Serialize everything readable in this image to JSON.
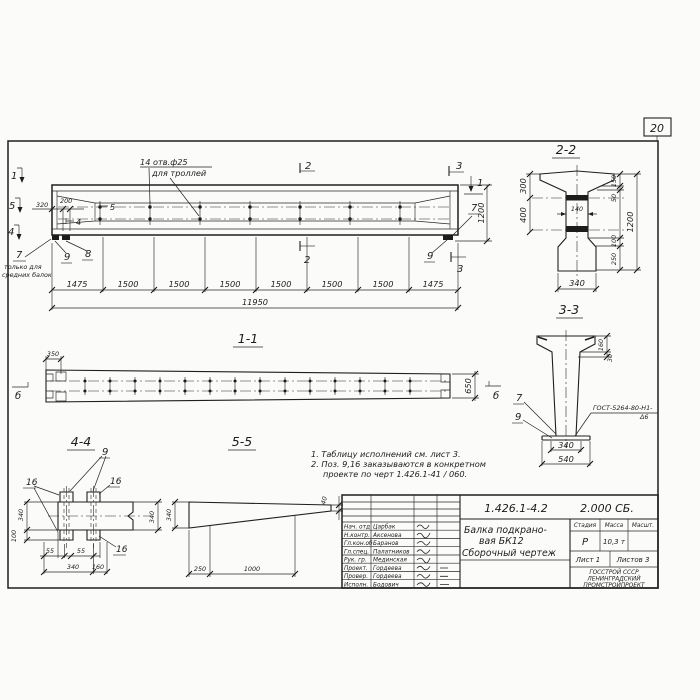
{
  "sheet": {
    "number": "20"
  },
  "main_view": {
    "holes_label_1": "14 отв.ф25",
    "holes_label_2": "для троллей",
    "mark_1_left": "1",
    "mark_5_left": "5",
    "mark_4_left": "4",
    "mark_5_inner": "5",
    "mark_4_inner": "4",
    "mark_2_top": "2",
    "mark_2_bottom": "2",
    "mark_3_top": "3",
    "mark_3_bottom": "3",
    "mark_1_right": "1",
    "callout_7_left": "7",
    "callout_7_note_1": "только для",
    "callout_7_note_2": "средних балок",
    "callout_9_left": "9",
    "callout_8_left": "8",
    "callout_7_right": "7",
    "callout_9_right": "9",
    "dim_320": "320",
    "dim_200": "200",
    "dim_1200": "1200",
    "dim_segments": [
      "1475",
      "1500",
      "1500",
      "1500",
      "1500",
      "1500",
      "1500",
      "1475"
    ],
    "dim_total": "11950"
  },
  "section_1_1": {
    "title": "1-1",
    "dim_350": "350",
    "dim_650": "650",
    "cut_mark_left": "б",
    "cut_mark_right": "б"
  },
  "section_2_2": {
    "title": "2-2",
    "dim_300": "300",
    "dim_400": "400",
    "dim_150": "150",
    "dim_50": "50",
    "dim_1200": "1200",
    "dim_100": "100",
    "dim_250": "250",
    "dim_140": "140",
    "dim_340": "340"
  },
  "section_3_3": {
    "title": "3-3",
    "dim_160": "160",
    "dim_30": "30",
    "dim_340": "340",
    "dim_540": "540",
    "callout_7": "7",
    "callout_9": "9",
    "weld_label_1": "ГОСТ-5264-80-Н1-",
    "weld_label_2": "Δ6"
  },
  "section_4_4": {
    "title": "4-4",
    "callout_9": "9",
    "callout_16_a": "16",
    "callout_16_b": "16",
    "callout_16_c": "16",
    "dim_340_left": "340",
    "dim_100": "100",
    "dim_340_right": "340",
    "dim_55_a": "55",
    "dim_55_b": "55",
    "dim_340_bottom": "340",
    "dim_160": "160"
  },
  "section_5_5": {
    "title": "5-5",
    "dim_340": "340",
    "dim_250": "250",
    "dim_1000": "1000",
    "dim_40": "40"
  },
  "notes": {
    "line_1": "1. Таблицу исполнений см. лист 3.",
    "line_2": "2. Поз. 9,16 заказываются в конкретном",
    "line_3": "проекте по черт 1.426.1-41 / 060."
  },
  "title_block": {
    "doc_number": "1.426.1-4.2",
    "doc_code": "2.000 СБ.",
    "title_1": "Балка подкрано-",
    "title_2": "вая БК12",
    "title_3": "Сборочный чертеж",
    "col_stage": "Стадия",
    "col_mass": "Масса",
    "col_scale": "Масшт.",
    "stage": "Р",
    "mass": "10,3 т",
    "sheet": "Лист 1",
    "sheets": "Листов 3",
    "org_1": "ГОССТРОЙ СССР",
    "org_2": "ЛЕНИНГРАДСКИЙ",
    "org_3": "ПРОМСТРОЙПРОЕКТ",
    "rows": [
      {
        "role": "Нач. отд",
        "name": "Царбак"
      },
      {
        "role": "Н.контр.",
        "name": "Аксенова"
      },
      {
        "role": "Гл.кон.об",
        "name": "Баранов"
      },
      {
        "role": "Гл.спец.",
        "name": "Палатников"
      },
      {
        "role": "Рук. гр.",
        "name": "Мединская"
      },
      {
        "role": "Проект.",
        "name": "Гордеева"
      },
      {
        "role": "Провер.",
        "name": "Гордеева"
      },
      {
        "role": "Исполн.",
        "name": "Бодович"
      }
    ]
  }
}
